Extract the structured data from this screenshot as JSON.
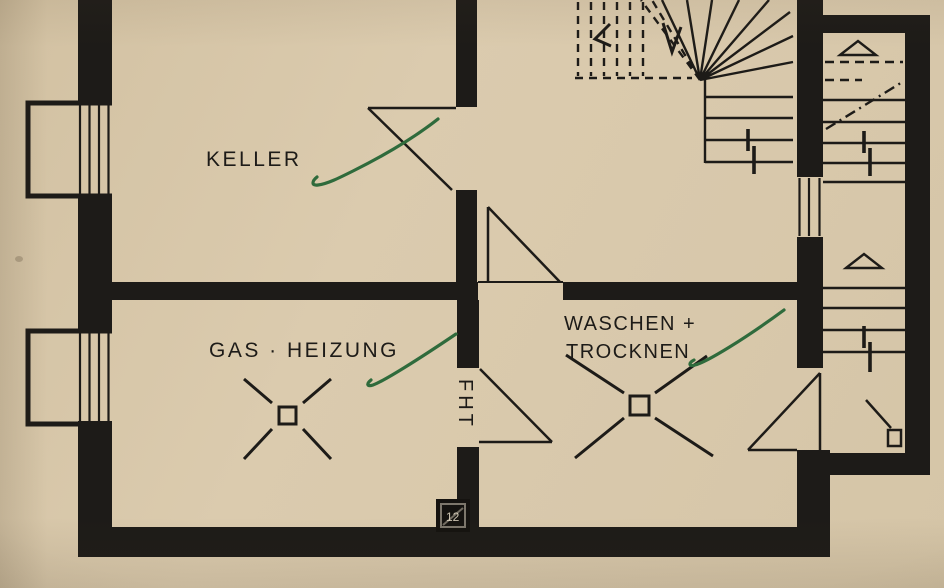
{
  "plan": {
    "rooms": [
      {
        "id": "keller",
        "label": "KELLER"
      },
      {
        "id": "gas-heizung",
        "label": "GAS · HEIZUNG"
      },
      {
        "id": "waschen-trocknen",
        "label_line1": "WASCHEN +",
        "label_line2": "TROCKNEN"
      }
    ],
    "door_label": "FHT",
    "stamp": {
      "text": "12"
    },
    "colors": {
      "paper": "#d8c8ab",
      "ink": "#1d1b18",
      "annotation_green": "#2f6b3c"
    }
  }
}
